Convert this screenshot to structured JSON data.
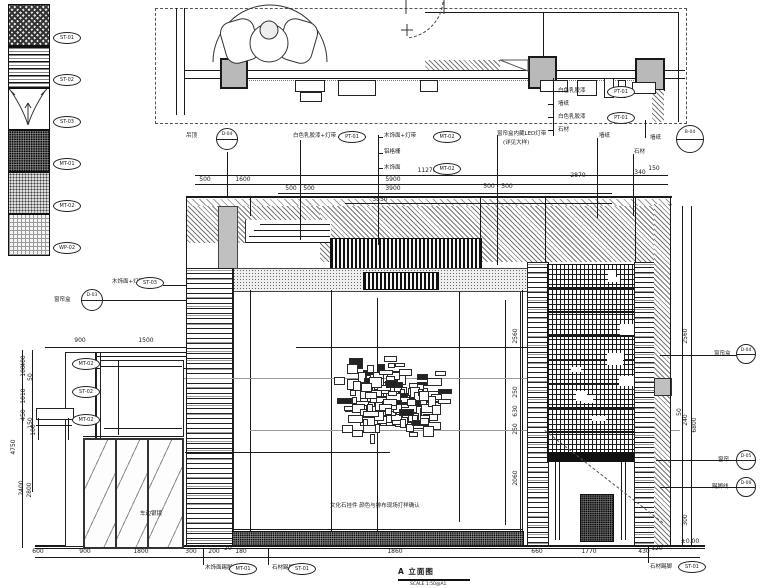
{
  "colors": {
    "line": "#1a1a1a",
    "gray": "#9a9a9a",
    "column_fill": "#b9b9b9",
    "paper": "#ffffff"
  },
  "title_block": {
    "title": "A 立面图",
    "scale": "SCALE 1:50@A1"
  },
  "legend": {
    "items": [
      {
        "tag": "ST-01",
        "pattern": "check"
      },
      {
        "tag": "ST-02",
        "pattern": "wood"
      },
      {
        "tag": "ST-03",
        "pattern": "curtain"
      },
      {
        "tag": "MT-01",
        "pattern": "dots-dense"
      },
      {
        "tag": "MT-02",
        "pattern": "dots-mid"
      },
      {
        "tag": "WP-02",
        "pattern": "grid-light"
      }
    ]
  },
  "dimensions": {
    "items": [
      {
        "t": "11270",
        "x": 427,
        "y": 171
      },
      {
        "t": "500",
        "x": 205,
        "y": 180
      },
      {
        "t": "1600",
        "x": 243,
        "y": 180
      },
      {
        "t": "5900",
        "x": 393,
        "y": 180
      },
      {
        "t": "2870",
        "x": 578,
        "y": 176
      },
      {
        "t": "340",
        "x": 640,
        "y": 173
      },
      {
        "t": "150",
        "x": 654,
        "y": 169
      },
      {
        "t": "500",
        "x": 291,
        "y": 189
      },
      {
        "t": "500",
        "x": 309,
        "y": 189
      },
      {
        "t": "3900",
        "x": 393,
        "y": 189
      },
      {
        "t": "500",
        "x": 489,
        "y": 187
      },
      {
        "t": "500",
        "x": 507,
        "y": 187
      },
      {
        "t": "3550",
        "x": 380,
        "y": 200
      },
      {
        "t": "900",
        "x": 80,
        "y": 341
      },
      {
        "t": "1500",
        "x": 146,
        "y": 341
      },
      {
        "t": "600",
        "x": 38,
        "y": 552
      },
      {
        "t": "900",
        "x": 85,
        "y": 552
      },
      {
        "t": "1800",
        "x": 141,
        "y": 552
      },
      {
        "t": "300",
        "x": 191,
        "y": 552
      },
      {
        "t": "200",
        "x": 214,
        "y": 552
      },
      {
        "t": "20",
        "x": 228,
        "y": 549
      },
      {
        "t": "180",
        "x": 241,
        "y": 552
      },
      {
        "t": "1860",
        "x": 395,
        "y": 552
      },
      {
        "t": "660",
        "x": 537,
        "y": 552
      },
      {
        "t": "1770",
        "x": 589,
        "y": 552
      },
      {
        "t": "430",
        "x": 644,
        "y": 552
      },
      {
        "t": "120",
        "x": 657,
        "y": 549
      },
      {
        "t": "4750",
        "x": 14,
        "y": 447,
        "rot": 1
      },
      {
        "t": "400",
        "x": 24,
        "y": 361,
        "rot": 1
      },
      {
        "t": "100",
        "x": 24,
        "y": 371,
        "rot": 1
      },
      {
        "t": "50",
        "x": 31,
        "y": 377,
        "rot": 1
      },
      {
        "t": "1010",
        "x": 24,
        "y": 396,
        "rot": 1
      },
      {
        "t": "450",
        "x": 24,
        "y": 415,
        "rot": 1
      },
      {
        "t": "150",
        "x": 31,
        "y": 423,
        "rot": 1
      },
      {
        "t": "100",
        "x": 34,
        "y": 430,
        "rot": 1
      },
      {
        "t": "2400",
        "x": 22,
        "y": 488,
        "rot": 1
      },
      {
        "t": "2800",
        "x": 30,
        "y": 490,
        "rot": 1
      },
      {
        "t": "2560",
        "x": 516,
        "y": 336,
        "rot": 1
      },
      {
        "t": "250",
        "x": 516,
        "y": 392,
        "rot": 1
      },
      {
        "t": "630",
        "x": 516,
        "y": 411,
        "rot": 1
      },
      {
        "t": "250",
        "x": 516,
        "y": 429,
        "rot": 1
      },
      {
        "t": "2060",
        "x": 516,
        "y": 478,
        "rot": 1
      },
      {
        "t": "2560",
        "x": 686,
        "y": 336,
        "rot": 1
      },
      {
        "t": "50",
        "x": 680,
        "y": 412,
        "rot": 1
      },
      {
        "t": "240",
        "x": 686,
        "y": 420,
        "rot": 1
      },
      {
        "t": "6800",
        "x": 695,
        "y": 425,
        "rot": 1
      },
      {
        "t": "300",
        "x": 686,
        "y": 520,
        "rot": 1
      },
      {
        "t": "±0.00",
        "x": 690,
        "y": 542
      }
    ]
  },
  "annotations": {
    "items": [
      {
        "t": "吊顶",
        "x": 186,
        "y": 133
      },
      {
        "t": "白色乳胶漆+灯带",
        "x": 293,
        "y": 133
      },
      {
        "t": "木饰面+灯带",
        "x": 384,
        "y": 133
      },
      {
        "t": "铝格栅",
        "x": 384,
        "y": 149
      },
      {
        "t": "木饰面",
        "x": 384,
        "y": 165
      },
      {
        "t": "窗帘盒内藏LED灯带",
        "x": 497,
        "y": 131
      },
      {
        "t": "(详见大样)",
        "x": 503,
        "y": 140
      },
      {
        "t": "墙纸",
        "x": 599,
        "y": 133
      },
      {
        "t": "石材",
        "x": 634,
        "y": 149
      },
      {
        "t": "白色乳胶漆",
        "x": 558,
        "y": 88
      },
      {
        "t": "墙纸",
        "x": 558,
        "y": 101
      },
      {
        "t": "白色乳胶漆",
        "x": 558,
        "y": 114
      },
      {
        "t": "石材",
        "x": 558,
        "y": 127
      },
      {
        "t": "墙纸",
        "x": 650,
        "y": 135
      },
      {
        "t": "窗帘盒",
        "x": 714,
        "y": 351
      },
      {
        "t": "窗帘",
        "x": 718,
        "y": 457
      },
      {
        "t": "踢脚线",
        "x": 712,
        "y": 484
      },
      {
        "t": "窗帘盒",
        "x": 54,
        "y": 297
      },
      {
        "t": "木饰面+灯带",
        "x": 112,
        "y": 279
      },
      {
        "t": "木饰面踢脚",
        "x": 205,
        "y": 565
      },
      {
        "t": "石材踢脚",
        "x": 272,
        "y": 565
      },
      {
        "t": "石材踢脚",
        "x": 650,
        "y": 564
      },
      {
        "t": "文化石挂件 颜色与排布现场打样确认",
        "x": 330,
        "y": 503
      },
      {
        "t": "车边银镜",
        "x": 140,
        "y": 511
      }
    ]
  },
  "material_tags": {
    "items": [
      {
        "t": "PT-01",
        "x": 352,
        "y": 137
      },
      {
        "t": "MT-02",
        "x": 447,
        "y": 137
      },
      {
        "t": "MT-02",
        "x": 447,
        "y": 169
      },
      {
        "t": "PT-01",
        "x": 621,
        "y": 92
      },
      {
        "t": "PT-01",
        "x": 621,
        "y": 118
      },
      {
        "t": "ST-03",
        "x": 150,
        "y": 283
      },
      {
        "t": "MT-02",
        "x": 86,
        "y": 364
      },
      {
        "t": "ST-02",
        "x": 86,
        "y": 392
      },
      {
        "t": "MT-02",
        "x": 86,
        "y": 420
      },
      {
        "t": "MT-01",
        "x": 243,
        "y": 569
      },
      {
        "t": "ST-01",
        "x": 302,
        "y": 569
      },
      {
        "t": "ST-01",
        "x": 692,
        "y": 567
      }
    ]
  },
  "callouts": {
    "items": [
      {
        "t": "D-04",
        "x": 227,
        "y": 139,
        "d": 20
      },
      {
        "t": "B-04",
        "x": 690,
        "y": 139,
        "d": 26
      },
      {
        "t": "D-03",
        "x": 92,
        "y": 300,
        "d": 20
      },
      {
        "t": "D-04",
        "x": 746,
        "y": 354,
        "d": 18
      },
      {
        "t": "D-05",
        "x": 746,
        "y": 460,
        "d": 18
      },
      {
        "t": "D-06",
        "x": 746,
        "y": 487,
        "d": 18
      }
    ]
  },
  "art_cluster": {
    "count": 175,
    "seed": 7,
    "cx": 386,
    "cy": 398,
    "sx": 66,
    "sy": 50,
    "xmin": 262,
    "xmax": 512,
    "ymin": 320,
    "ymax": 478,
    "min_w": 3,
    "max_w": 14,
    "min_h": 2,
    "max_h": 9,
    "fill_ratio": 0.14
  },
  "lattice_patches": {
    "count": 10,
    "seed": 3,
    "x": 550,
    "y": 270,
    "w": 80,
    "h": 175
  }
}
